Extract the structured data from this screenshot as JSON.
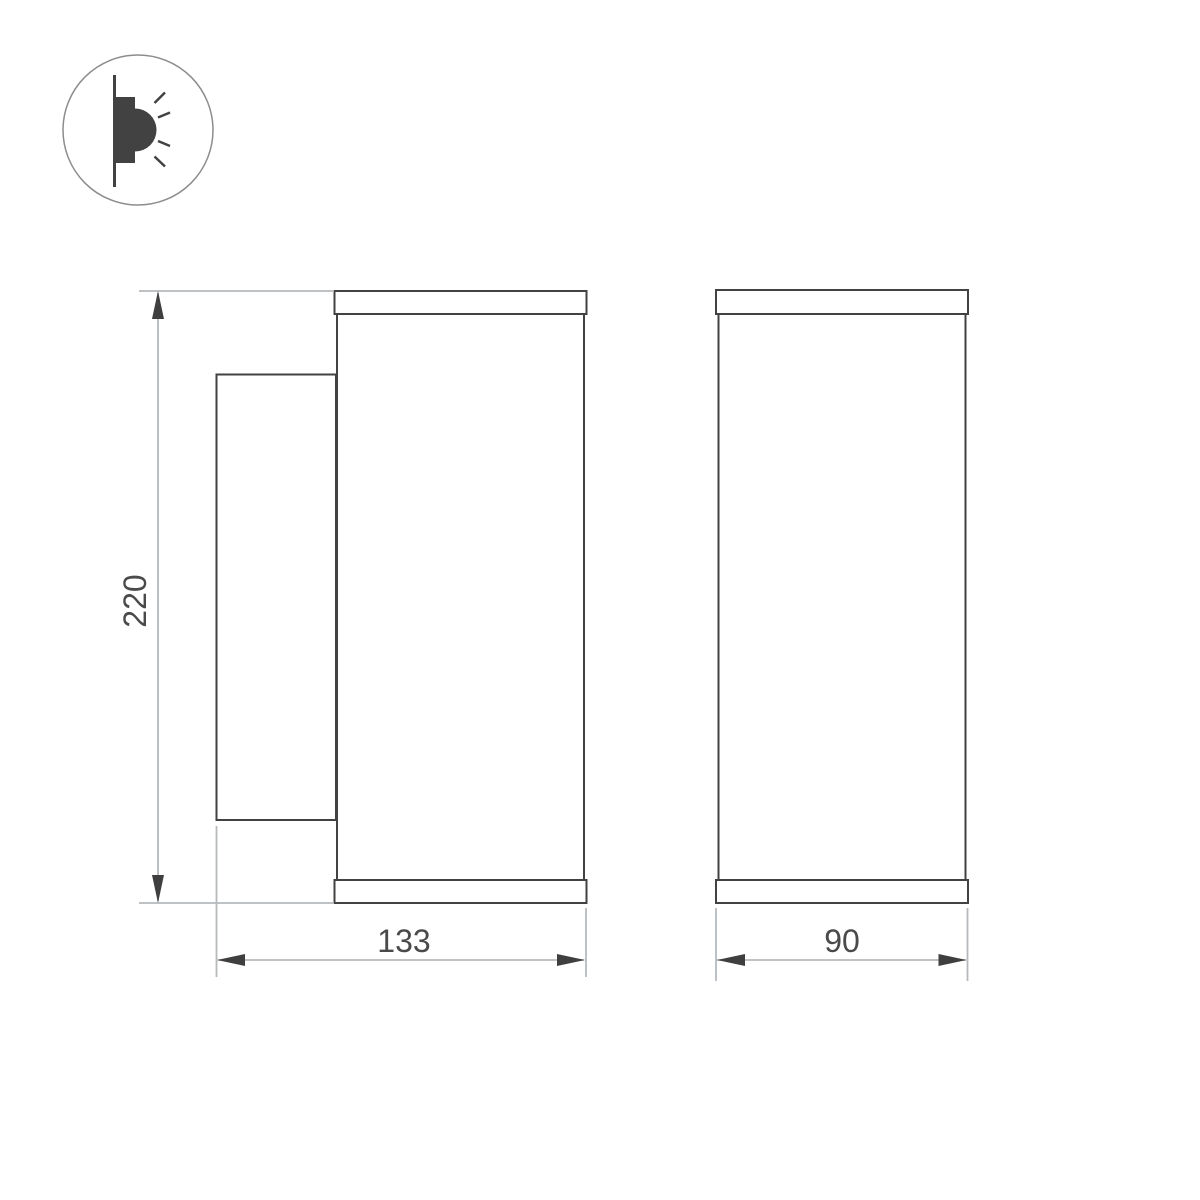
{
  "drawing": {
    "title": "wall-mounted-luminaire-dimension-drawing",
    "background_color": "#ffffff",
    "colors": {
      "shape_outline": "#424242",
      "dimension_line": "#abafb3",
      "extension_line": "#b6babd",
      "arrowhead": "#3f3f3f",
      "label_text": "#4a4a4a",
      "icon_circle": "#8c8c8c",
      "icon_glyph": "#424242"
    },
    "icon": {
      "name": "wall-mounted-light-icon",
      "parts": [
        "wall-line",
        "lamp-body",
        "lamp-lens",
        "light-rays"
      ]
    },
    "views": {
      "side": {
        "name": "side-view",
        "parts": [
          "top-cap",
          "cylinder-body",
          "bottom-cap",
          "wall-plate"
        ]
      },
      "front": {
        "name": "front-view",
        "parts": [
          "top-cap",
          "cylinder-body",
          "bottom-cap"
        ]
      }
    },
    "dimensions": {
      "height": {
        "label": "220",
        "value": 220,
        "orientation": "vertical"
      },
      "side_depth": {
        "label": "133",
        "value": 133,
        "orientation": "horizontal"
      },
      "front_width": {
        "label": "90",
        "value": 90,
        "orientation": "horizontal"
      }
    }
  }
}
